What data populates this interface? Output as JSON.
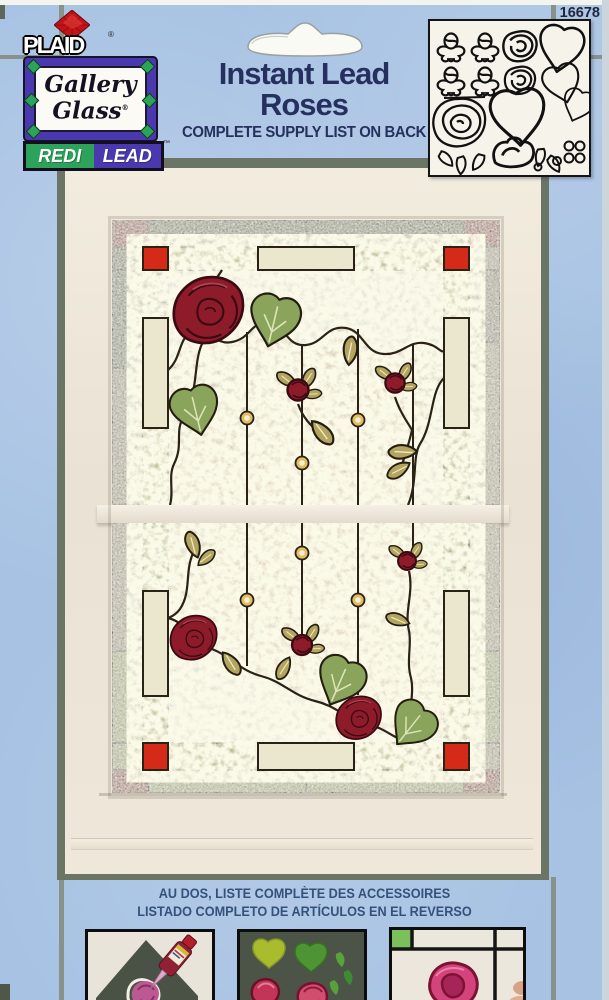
{
  "package": {
    "item_number": "16678",
    "brand": "PLAID",
    "brand_reg_mark": "®",
    "logo": {
      "line1": "Gallery",
      "line2": "Glass",
      "reg_mark": "®"
    },
    "sub_brand": {
      "left": "REDI",
      "right": "LEAD",
      "tm_mark": "™"
    },
    "title": {
      "line1": "Instant Lead",
      "line2": "Roses"
    },
    "supply_note": "COMPLETE SUPPLY LIST ON BACK",
    "footer": {
      "french": "AU DOS, LISTE COMPLÈTE DES ACCESSOIRES",
      "spanish": "LISTADO COMPLETO DE ARTÍCULOS EN EL REVERSO"
    }
  },
  "colors": {
    "background_blue": "#a7c2e3",
    "grout_grey": "#87928a",
    "navy_text": "#26305f",
    "footer_blue": "#34517c",
    "accent_red": "#d52a18",
    "dark_red_glass": "#7e1322",
    "rose_red": "#8e1b2a",
    "leaf_green": "#8aa45c",
    "logo_green": "#2ca25a",
    "logo_purple": "#4a38ae",
    "frame_white": "#eee7db",
    "sage_edge": "#6b7566",
    "cream_glass": "#ebe7cf",
    "amber_glass": "#b18b5c",
    "grey_glass": "#b3b4bc",
    "dark_green_glass": "#55624a",
    "olive_glass": "#a5a168",
    "lead_line": "#2b2217"
  },
  "pattern_panel": {
    "pieces": [
      "rosebud",
      "rosebud",
      "rosebud",
      "rosebud",
      "medium-rose",
      "medium-rose",
      "large-rose",
      "ivy-leaf",
      "ivy-leaf",
      "heart-leaf",
      "small-leaf",
      "tulip-rose",
      "petal-leaves",
      "berry-dots"
    ]
  },
  "steps": [
    {
      "name": "squeeze-liquid-lead-onto-pattern"
    },
    {
      "name": "paint-glass-colors"
    },
    {
      "name": "finished-stained-glass-window"
    }
  ]
}
